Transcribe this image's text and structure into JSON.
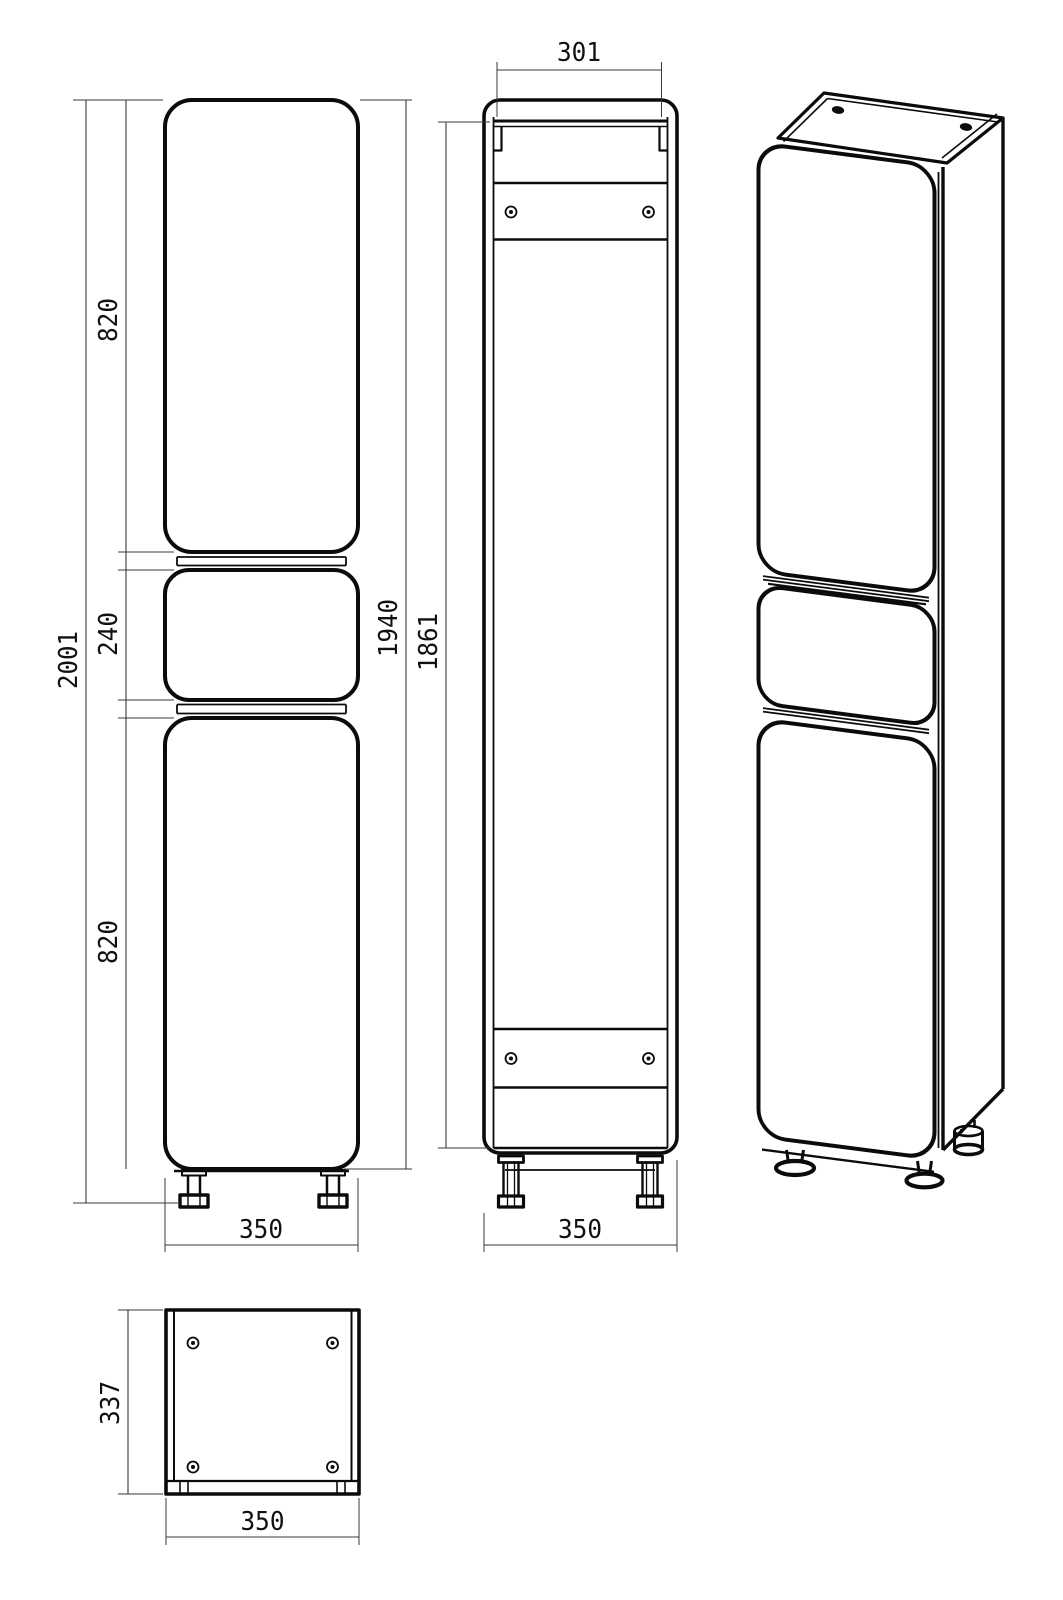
{
  "drawing": {
    "type": "furniture technical drawing, tall bathroom cabinet (pencil case), 4 views",
    "background": "#ffffff",
    "colors": {
      "line": "#0b0b0b",
      "dim_line": "#3a3a3a",
      "text": "#111111"
    },
    "dimensions": {
      "front": {
        "overall_height": "2001",
        "upper_door_height": "820",
        "drawer_height": "240",
        "lower_door_height": "820",
        "carcass_height": "1940",
        "width": "350"
      },
      "back": {
        "top_opening_width": "301",
        "back_panel_height": "1861",
        "width": "350"
      },
      "bottom": {
        "depth": "337",
        "width": "350"
      }
    }
  }
}
